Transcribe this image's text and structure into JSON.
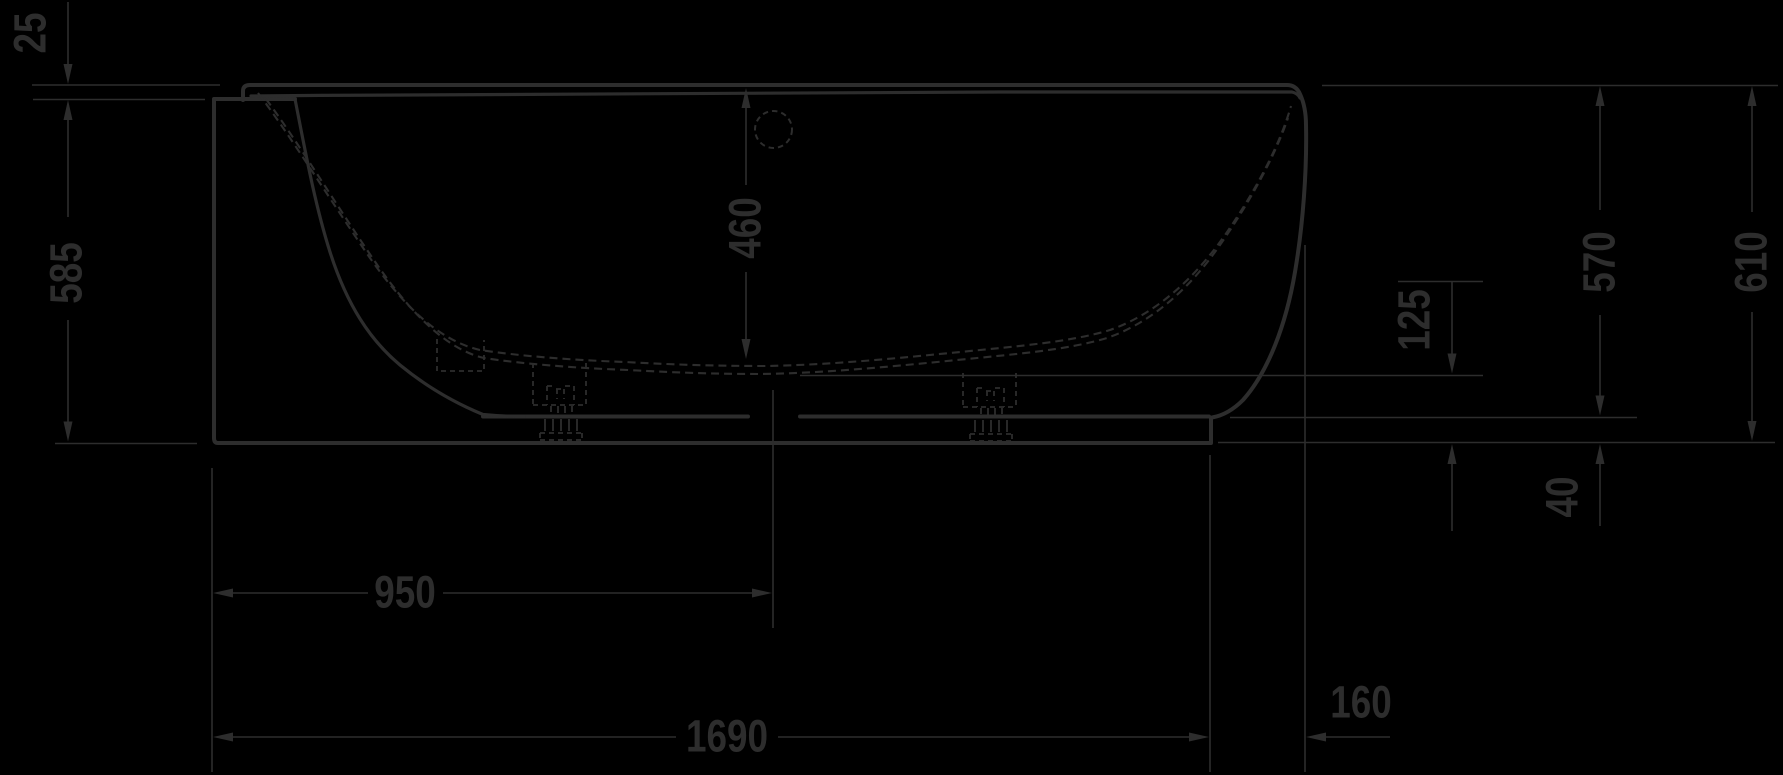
{
  "colors": {
    "background": "#000000",
    "line": "#2d2d2d"
  },
  "dimensions": {
    "v25": "25",
    "v585": "585",
    "v460": "460",
    "v570": "570",
    "v610": "610",
    "v125": "125",
    "v40": "40",
    "v950": "950",
    "v1690": "1690",
    "v160": "160"
  }
}
